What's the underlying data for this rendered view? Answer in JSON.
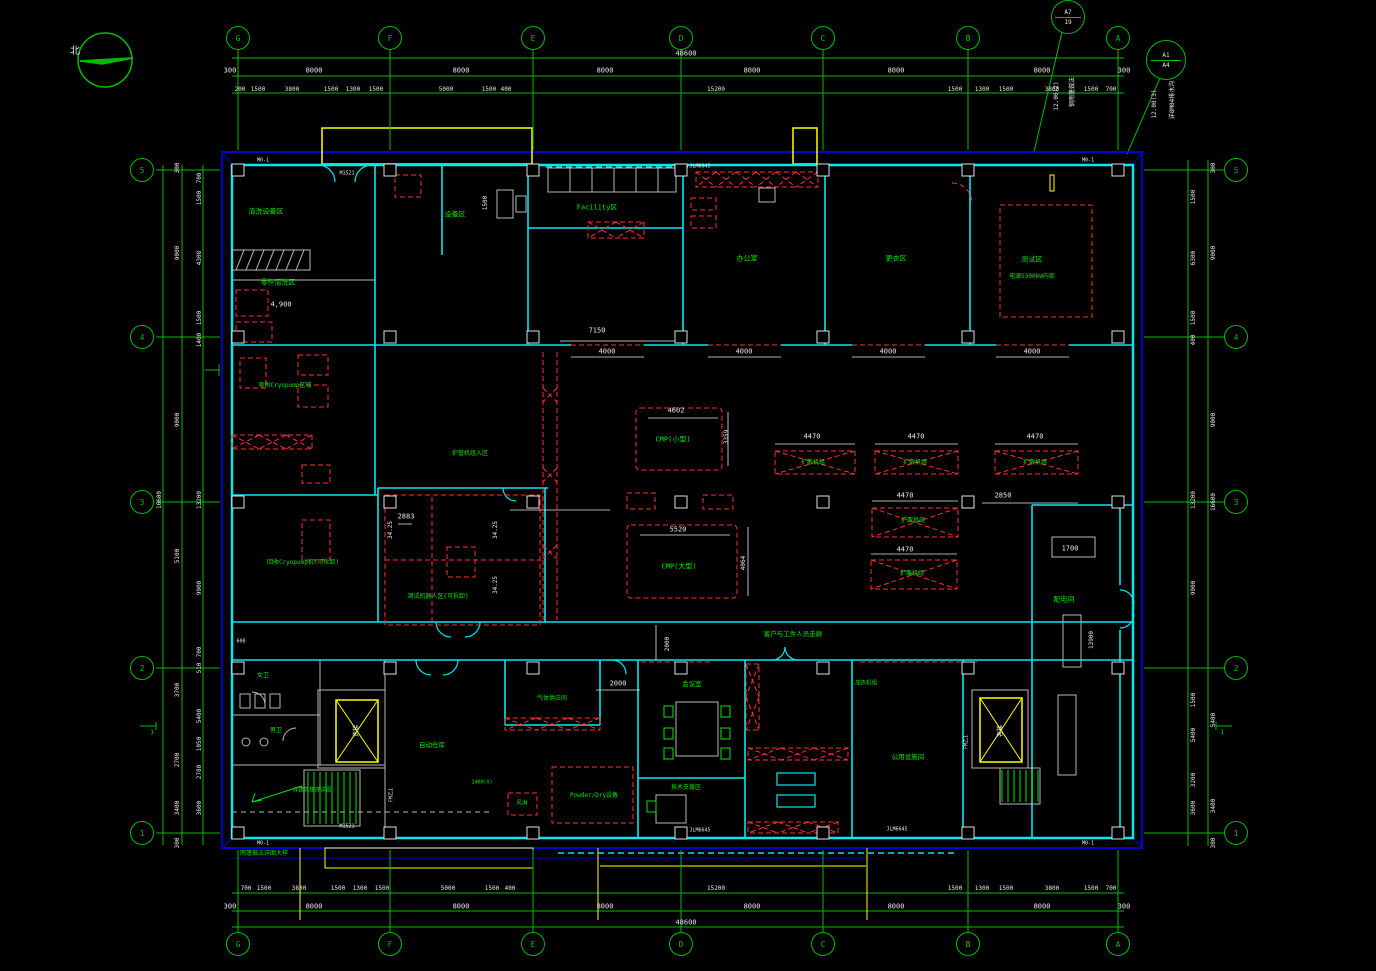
{
  "palette": {
    "bg": "#000000",
    "grid": "#00bb00",
    "wall": "#00e8f0",
    "border": "#0000d0",
    "equip": "#ff3030",
    "dim": "#e8e8e8",
    "label": "#00e800",
    "canopy": "#ffff00",
    "fixture": "#b8b8b8"
  },
  "north": {
    "label": "北"
  },
  "grid": {
    "cols": [
      {
        "id": "G",
        "x": 238
      },
      {
        "id": "F",
        "x": 390
      },
      {
        "id": "E",
        "x": 533
      },
      {
        "id": "D",
        "x": 681
      },
      {
        "id": "C",
        "x": 823
      },
      {
        "id": "B",
        "x": 968
      },
      {
        "id": "A",
        "x": 1118
      }
    ],
    "rows": [
      {
        "id": "5",
        "y": 170
      },
      {
        "id": "4",
        "y": 337
      },
      {
        "id": "3",
        "y": 502
      },
      {
        "id": "2",
        "y": 668
      },
      {
        "id": "1",
        "y": 833
      }
    ],
    "top_y": 38,
    "bottom_y": 944,
    "left_x": 142,
    "right_x": 1236
  },
  "ref_bubbles": [
    {
      "a": "A7",
      "b": "19",
      "x": 1068,
      "y": 17,
      "r": 16
    },
    {
      "a": "A1",
      "b": "A4",
      "x": 1166,
      "y": 60,
      "r": 19
    }
  ],
  "texts": [
    {
      "t": "48600",
      "x": 686,
      "y": 54,
      "c": "w",
      "s": 7
    },
    {
      "t": "300",
      "x": 230,
      "y": 71,
      "c": "w",
      "s": 7
    },
    {
      "t": "8000",
      "x": 314,
      "y": 71,
      "c": "w",
      "s": 7
    },
    {
      "t": "8000",
      "x": 461,
      "y": 71,
      "c": "w",
      "s": 7
    },
    {
      "t": "8000",
      "x": 605,
      "y": 71,
      "c": "w",
      "s": 7
    },
    {
      "t": "8000",
      "x": 752,
      "y": 71,
      "c": "w",
      "s": 7
    },
    {
      "t": "8000",
      "x": 896,
      "y": 71,
      "c": "w",
      "s": 7
    },
    {
      "t": "8000",
      "x": 1042,
      "y": 71,
      "c": "w",
      "s": 7
    },
    {
      "t": "300",
      "x": 1124,
      "y": 71,
      "c": "w",
      "s": 7
    },
    {
      "t": "200",
      "x": 240,
      "y": 90,
      "c": "w",
      "s": 6
    },
    {
      "t": "1500",
      "x": 258,
      "y": 90,
      "c": "w",
      "s": 6
    },
    {
      "t": "3800",
      "x": 292,
      "y": 90,
      "c": "w",
      "s": 6
    },
    {
      "t": "1500",
      "x": 331,
      "y": 90,
      "c": "w",
      "s": 6
    },
    {
      "t": "1300",
      "x": 353,
      "y": 90,
      "c": "w",
      "s": 6
    },
    {
      "t": "1500",
      "x": 376,
      "y": 90,
      "c": "w",
      "s": 6
    },
    {
      "t": "5000",
      "x": 446,
      "y": 90,
      "c": "w",
      "s": 6
    },
    {
      "t": "1500",
      "x": 489,
      "y": 90,
      "c": "w",
      "s": 6
    },
    {
      "t": "400",
      "x": 506,
      "y": 90,
      "c": "w",
      "s": 6
    },
    {
      "t": "15200",
      "x": 716,
      "y": 90,
      "c": "w",
      "s": 6
    },
    {
      "t": "1500",
      "x": 955,
      "y": 90,
      "c": "w",
      "s": 6
    },
    {
      "t": "1300",
      "x": 982,
      "y": 90,
      "c": "w",
      "s": 6
    },
    {
      "t": "1500",
      "x": 1006,
      "y": 90,
      "c": "w",
      "s": 6
    },
    {
      "t": "3800",
      "x": 1052,
      "y": 90,
      "c": "w",
      "s": 6
    },
    {
      "t": "1500",
      "x": 1091,
      "y": 90,
      "c": "w",
      "s": 6
    },
    {
      "t": "700",
      "x": 1111,
      "y": 90,
      "c": "w",
      "s": 6
    },
    {
      "t": "700",
      "x": 246,
      "y": 889,
      "c": "w",
      "s": 6
    },
    {
      "t": "1500",
      "x": 264,
      "y": 889,
      "c": "w",
      "s": 6
    },
    {
      "t": "3800",
      "x": 299,
      "y": 889,
      "c": "w",
      "s": 6
    },
    {
      "t": "1500",
      "x": 338,
      "y": 889,
      "c": "w",
      "s": 6
    },
    {
      "t": "1300",
      "x": 360,
      "y": 889,
      "c": "w",
      "s": 6
    },
    {
      "t": "1500",
      "x": 382,
      "y": 889,
      "c": "w",
      "s": 6
    },
    {
      "t": "5000",
      "x": 448,
      "y": 889,
      "c": "w",
      "s": 6
    },
    {
      "t": "1500",
      "x": 492,
      "y": 889,
      "c": "w",
      "s": 6
    },
    {
      "t": "400",
      "x": 510,
      "y": 889,
      "c": "w",
      "s": 6
    },
    {
      "t": "15200",
      "x": 716,
      "y": 889,
      "c": "w",
      "s": 6
    },
    {
      "t": "1500",
      "x": 955,
      "y": 889,
      "c": "w",
      "s": 6
    },
    {
      "t": "1300",
      "x": 982,
      "y": 889,
      "c": "w",
      "s": 6
    },
    {
      "t": "1500",
      "x": 1006,
      "y": 889,
      "c": "w",
      "s": 6
    },
    {
      "t": "3800",
      "x": 1052,
      "y": 889,
      "c": "w",
      "s": 6
    },
    {
      "t": "1500",
      "x": 1091,
      "y": 889,
      "c": "w",
      "s": 6
    },
    {
      "t": "700",
      "x": 1111,
      "y": 889,
      "c": "w",
      "s": 6
    },
    {
      "t": "300",
      "x": 230,
      "y": 907,
      "c": "w",
      "s": 7
    },
    {
      "t": "8000",
      "x": 314,
      "y": 907,
      "c": "w",
      "s": 7
    },
    {
      "t": "8000",
      "x": 461,
      "y": 907,
      "c": "w",
      "s": 7
    },
    {
      "t": "8000",
      "x": 605,
      "y": 907,
      "c": "w",
      "s": 7
    },
    {
      "t": "8000",
      "x": 752,
      "y": 907,
      "c": "w",
      "s": 7
    },
    {
      "t": "8000",
      "x": 896,
      "y": 907,
      "c": "w",
      "s": 7
    },
    {
      "t": "8000",
      "x": 1042,
      "y": 907,
      "c": "w",
      "s": 7
    },
    {
      "t": "300",
      "x": 1124,
      "y": 907,
      "c": "w",
      "s": 7
    },
    {
      "t": "48600",
      "x": 686,
      "y": 923,
      "c": "w",
      "s": 7
    },
    {
      "t": "16600",
      "x": 160,
      "y": 500,
      "c": "w",
      "s": 6,
      "r": -90
    },
    {
      "t": "300",
      "x": 178,
      "y": 168,
      "c": "w",
      "s": 6,
      "r": -90
    },
    {
      "t": "9000",
      "x": 178,
      "y": 253,
      "c": "w",
      "s": 6,
      "r": -90
    },
    {
      "t": "9000",
      "x": 178,
      "y": 420,
      "c": "w",
      "s": 6,
      "r": -90
    },
    {
      "t": "5100",
      "x": 178,
      "y": 556,
      "c": "w",
      "s": 6,
      "r": -90
    },
    {
      "t": "3700",
      "x": 178,
      "y": 690,
      "c": "w",
      "s": 6,
      "r": -90
    },
    {
      "t": "2700",
      "x": 178,
      "y": 760,
      "c": "w",
      "s": 6,
      "r": -90
    },
    {
      "t": "3400",
      "x": 178,
      "y": 808,
      "c": "w",
      "s": 6,
      "r": -90
    },
    {
      "t": "300",
      "x": 178,
      "y": 843,
      "c": "w",
      "s": 6,
      "r": -90
    },
    {
      "t": "700",
      "x": 200,
      "y": 178,
      "c": "w",
      "s": 6,
      "r": -90
    },
    {
      "t": "1500",
      "x": 200,
      "y": 198,
      "c": "w",
      "s": 6,
      "r": -90
    },
    {
      "t": "4308",
      "x": 200,
      "y": 258,
      "c": "w",
      "s": 6,
      "r": -90
    },
    {
      "t": "1500",
      "x": 200,
      "y": 318,
      "c": "w",
      "s": 6,
      "r": -90
    },
    {
      "t": "1400",
      "x": 200,
      "y": 340,
      "c": "w",
      "s": 6,
      "r": -90
    },
    {
      "t": "13200",
      "x": 200,
      "y": 500,
      "c": "w",
      "s": 6,
      "r": -90
    },
    {
      "t": "9900",
      "x": 200,
      "y": 588,
      "c": "w",
      "s": 6,
      "r": -90
    },
    {
      "t": "700",
      "x": 200,
      "y": 652,
      "c": "w",
      "s": 6,
      "r": -90
    },
    {
      "t": "510",
      "x": 200,
      "y": 668,
      "c": "w",
      "s": 6,
      "r": -90
    },
    {
      "t": "5400",
      "x": 200,
      "y": 716,
      "c": "w",
      "s": 6,
      "r": -90
    },
    {
      "t": "1050",
      "x": 200,
      "y": 744,
      "c": "w",
      "s": 6,
      "r": -90
    },
    {
      "t": "2780",
      "x": 200,
      "y": 772,
      "c": "w",
      "s": 6,
      "r": -90
    },
    {
      "t": "3600",
      "x": 200,
      "y": 808,
      "c": "w",
      "s": 6,
      "r": -90
    },
    {
      "t": "1500",
      "x": 1194,
      "y": 197,
      "c": "w",
      "s": 6,
      "r": -90
    },
    {
      "t": "6300",
      "x": 1194,
      "y": 258,
      "c": "w",
      "s": 6,
      "r": -90
    },
    {
      "t": "1500",
      "x": 1194,
      "y": 318,
      "c": "w",
      "s": 6,
      "r": -90
    },
    {
      "t": "400",
      "x": 1194,
      "y": 340,
      "c": "w",
      "s": 6,
      "r": -90
    },
    {
      "t": "13200",
      "x": 1194,
      "y": 500,
      "c": "w",
      "s": 6,
      "r": -90
    },
    {
      "t": "9900",
      "x": 1194,
      "y": 588,
      "c": "w",
      "s": 6,
      "r": -90
    },
    {
      "t": "1500",
      "x": 1194,
      "y": 700,
      "c": "w",
      "s": 6,
      "r": -90
    },
    {
      "t": "5400",
      "x": 1194,
      "y": 735,
      "c": "w",
      "s": 6,
      "r": -90
    },
    {
      "t": "3200",
      "x": 1194,
      "y": 780,
      "c": "w",
      "s": 6,
      "r": -90
    },
    {
      "t": "3600",
      "x": 1194,
      "y": 808,
      "c": "w",
      "s": 6,
      "r": -90
    },
    {
      "t": "300",
      "x": 1214,
      "y": 168,
      "c": "w",
      "s": 6,
      "r": -90
    },
    {
      "t": "9000",
      "x": 1214,
      "y": 253,
      "c": "w",
      "s": 6,
      "r": -90
    },
    {
      "t": "9000",
      "x": 1214,
      "y": 420,
      "c": "w",
      "s": 6,
      "r": -90
    },
    {
      "t": "16600",
      "x": 1214,
      "y": 502,
      "c": "w",
      "s": 6,
      "r": -90
    },
    {
      "t": "5400",
      "x": 1214,
      "y": 720,
      "c": "w",
      "s": 6,
      "r": -90
    },
    {
      "t": "3400",
      "x": 1214,
      "y": 806,
      "c": "w",
      "s": 6,
      "r": -90
    },
    {
      "t": "300",
      "x": 1214,
      "y": 843,
      "c": "w",
      "s": 6,
      "r": -90
    },
    {
      "t": "7150",
      "x": 597,
      "y": 331,
      "c": "w",
      "s": 7
    },
    {
      "t": "4000",
      "x": 607,
      "y": 352,
      "c": "w",
      "s": 7
    },
    {
      "t": "4000",
      "x": 744,
      "y": 352,
      "c": "w",
      "s": 7
    },
    {
      "t": "4000",
      "x": 888,
      "y": 352,
      "c": "w",
      "s": 7
    },
    {
      "t": "4000",
      "x": 1032,
      "y": 352,
      "c": "w",
      "s": 7
    },
    {
      "t": "4602",
      "x": 676,
      "y": 411,
      "c": "w",
      "s": 7
    },
    {
      "t": "3359",
      "x": 727,
      "y": 437,
      "c": "w",
      "s": 6,
      "r": -90
    },
    {
      "t": "5520",
      "x": 678,
      "y": 530,
      "c": "w",
      "s": 7
    },
    {
      "t": "4064",
      "x": 744,
      "y": 563,
      "c": "w",
      "s": 6,
      "r": -90
    },
    {
      "t": "4470",
      "x": 812,
      "y": 437,
      "c": "w",
      "s": 7
    },
    {
      "t": "4470",
      "x": 916,
      "y": 437,
      "c": "w",
      "s": 7
    },
    {
      "t": "4470",
      "x": 1035,
      "y": 437,
      "c": "w",
      "s": 7
    },
    {
      "t": "4470",
      "x": 905,
      "y": 496,
      "c": "w",
      "s": 7
    },
    {
      "t": "4470",
      "x": 905,
      "y": 550,
      "c": "w",
      "s": 7
    },
    {
      "t": "2850",
      "x": 1003,
      "y": 496,
      "c": "w",
      "s": 7
    },
    {
      "t": "2883",
      "x": 406,
      "y": 517,
      "c": "w",
      "s": 7
    },
    {
      "t": "34.25",
      "x": 391,
      "y": 530,
      "c": "w",
      "s": 6,
      "r": -90
    },
    {
      "t": "34.25",
      "x": 496,
      "y": 530,
      "c": "w",
      "s": 6,
      "r": -90
    },
    {
      "t": "34.25",
      "x": 496,
      "y": 585,
      "c": "w",
      "s": 6,
      "r": -90
    },
    {
      "t": "1500",
      "x": 486,
      "y": 203,
      "c": "w",
      "s": 6,
      "r": -90
    },
    {
      "t": "1700",
      "x": 1070,
      "y": 549,
      "c": "w",
      "s": 7
    },
    {
      "t": "13900",
      "x": 1092,
      "y": 640,
      "c": "w",
      "s": 6,
      "r": -90
    },
    {
      "t": "2000",
      "x": 668,
      "y": 644,
      "c": "w",
      "s": 6,
      "r": -90
    },
    {
      "t": "2000",
      "x": 618,
      "y": 684,
      "c": "w",
      "s": 7
    },
    {
      "t": "4,900",
      "x": 281,
      "y": 305,
      "c": "w",
      "s": 7
    },
    {
      "t": "600",
      "x": 241,
      "y": 642,
      "c": "w",
      "s": 5
    },
    {
      "t": "12.00(2)",
      "x": 1057,
      "y": 96,
      "c": "w",
      "s": 6,
      "r": -90
    },
    {
      "t": "钢雨篷做法",
      "x": 1073,
      "y": 92,
      "c": "w",
      "s": 6,
      "r": -90
    },
    {
      "t": "12.00(3)",
      "x": 1155,
      "y": 104,
      "c": "w",
      "s": 6,
      "r": -90
    },
    {
      "t": "详8M04排水沟",
      "x": 1173,
      "y": 100,
      "c": "w",
      "s": 6,
      "r": -90
    },
    {
      "t": "M0-1",
      "x": 263,
      "y": 161,
      "c": "w",
      "s": 5
    },
    {
      "t": "M0-1",
      "x": 1088,
      "y": 161,
      "c": "w",
      "s": 5
    },
    {
      "t": "M0-1",
      "x": 263,
      "y": 844,
      "c": "w",
      "s": 5
    },
    {
      "t": "M0-1",
      "x": 1088,
      "y": 844,
      "c": "w",
      "s": 5
    },
    {
      "t": "M1521",
      "x": 347,
      "y": 174,
      "c": "w",
      "s": 5
    },
    {
      "t": "M1521",
      "x": 347,
      "y": 827,
      "c": "w",
      "s": 5
    },
    {
      "t": "JLM6645",
      "x": 700,
      "y": 167,
      "c": "w",
      "s": 5
    },
    {
      "t": "JLM6645",
      "x": 700,
      "y": 831,
      "c": "w",
      "s": 5
    },
    {
      "t": "JLM6645",
      "x": 897,
      "y": 830,
      "c": "w",
      "s": 5
    },
    {
      "t": "FM乙1",
      "x": 392,
      "y": 795,
      "c": "w",
      "s": 5,
      "r": -90
    },
    {
      "t": "FM乙1",
      "x": 967,
      "y": 742,
      "c": "w",
      "s": 5,
      "r": -90
    },
    {
      "t": "货梯",
      "x": 357,
      "y": 731,
      "c": "w",
      "s": 6,
      "r": -90
    },
    {
      "t": "客梯",
      "x": 1001,
      "y": 731,
      "c": "w",
      "s": 6,
      "r": -90
    },
    {
      "t": "清洗设备区",
      "x": 266,
      "y": 212,
      "c": "g",
      "s": 7
    },
    {
      "t": "零件清洗区",
      "x": 278,
      "y": 283,
      "c": "g",
      "s": 7
    },
    {
      "t": "设备区",
      "x": 455,
      "y": 215,
      "c": "g",
      "s": 7
    },
    {
      "t": "Facility区",
      "x": 597,
      "y": 208,
      "c": "g",
      "s": 7
    },
    {
      "t": "办公室",
      "x": 747,
      "y": 259,
      "c": "g",
      "s": 7
    },
    {
      "t": "更衣区",
      "x": 896,
      "y": 259,
      "c": "g",
      "s": 7
    },
    {
      "t": "测试区",
      "x": 1032,
      "y": 260,
      "c": "g",
      "s": 7
    },
    {
      "t": "电源5300kW内部",
      "x": 1032,
      "y": 277,
      "c": "g",
      "s": 6
    },
    {
      "t": "吸附Cryopump区域",
      "x": 285,
      "y": 386,
      "c": "g",
      "s": 6
    },
    {
      "t": "回收Cryopump机(可拆卸)",
      "x": 303,
      "y": 563,
      "c": "g",
      "s": 6
    },
    {
      "t": "测试机器人区(可拆卸)",
      "x": 438,
      "y": 597,
      "c": "g",
      "s": 6
    },
    {
      "t": "炉管机组入区",
      "x": 470,
      "y": 454,
      "c": "g",
      "s": 6
    },
    {
      "t": "CMP(小型)",
      "x": 673,
      "y": 440,
      "c": "g",
      "s": 7
    },
    {
      "t": "CMP(大型)",
      "x": 679,
      "y": 567,
      "c": "g",
      "s": 7
    },
    {
      "t": "扩散机组",
      "x": 813,
      "y": 463,
      "c": "g",
      "s": 6
    },
    {
      "t": "扩散机组",
      "x": 915,
      "y": 463,
      "c": "g",
      "s": 6
    },
    {
      "t": "扩散机组",
      "x": 1035,
      "y": 463,
      "c": "g",
      "s": 6
    },
    {
      "t": "扩散机组",
      "x": 913,
      "y": 521,
      "c": "g",
      "s": 6
    },
    {
      "t": "扩散机组",
      "x": 912,
      "y": 574,
      "c": "g",
      "s": 6
    },
    {
      "t": "配电间",
      "x": 1064,
      "y": 600,
      "c": "g",
      "s": 7
    },
    {
      "t": "女卫",
      "x": 263,
      "y": 676,
      "c": "g",
      "s": 6
    },
    {
      "t": "男卫",
      "x": 276,
      "y": 731,
      "c": "g",
      "s": 6
    },
    {
      "t": "详建筑楼梯详图",
      "x": 312,
      "y": 791,
      "c": "g",
      "s": 5.5
    },
    {
      "t": "会议室",
      "x": 692,
      "y": 684,
      "c": "g",
      "s": 6.5
    },
    {
      "t": "技术支援区",
      "x": 686,
      "y": 788,
      "c": "g",
      "s": 6
    },
    {
      "t": "自动仓库",
      "x": 432,
      "y": 745,
      "c": "g",
      "s": 6.5
    },
    {
      "t": "气体供应间",
      "x": 552,
      "y": 699,
      "c": "g",
      "s": 6
    },
    {
      "t": "Powder/Dry设备",
      "x": 594,
      "y": 796,
      "c": "g",
      "s": 6
    },
    {
      "t": "风淋",
      "x": 522,
      "y": 804,
      "c": "g",
      "s": 5.5
    },
    {
      "t": "1400(X)",
      "x": 482,
      "y": 783,
      "c": "g",
      "s": 5
    },
    {
      "t": "加热机组",
      "x": 866,
      "y": 684,
      "c": "g",
      "s": 5.5
    },
    {
      "t": "公用设施间",
      "x": 908,
      "y": 757,
      "c": "g",
      "s": 6.5
    },
    {
      "t": "客户与工件人员走廊",
      "x": 793,
      "y": 634,
      "c": "g",
      "s": 6.5
    },
    {
      "t": "雨篷做法详图大样",
      "x": 264,
      "y": 854,
      "c": "g",
      "s": 6
    },
    {
      "t": "1",
      "x": 152,
      "y": 733,
      "c": "g",
      "s": 6
    },
    {
      "t": "1",
      "x": 1222,
      "y": 733,
      "c": "g",
      "s": 6
    }
  ]
}
